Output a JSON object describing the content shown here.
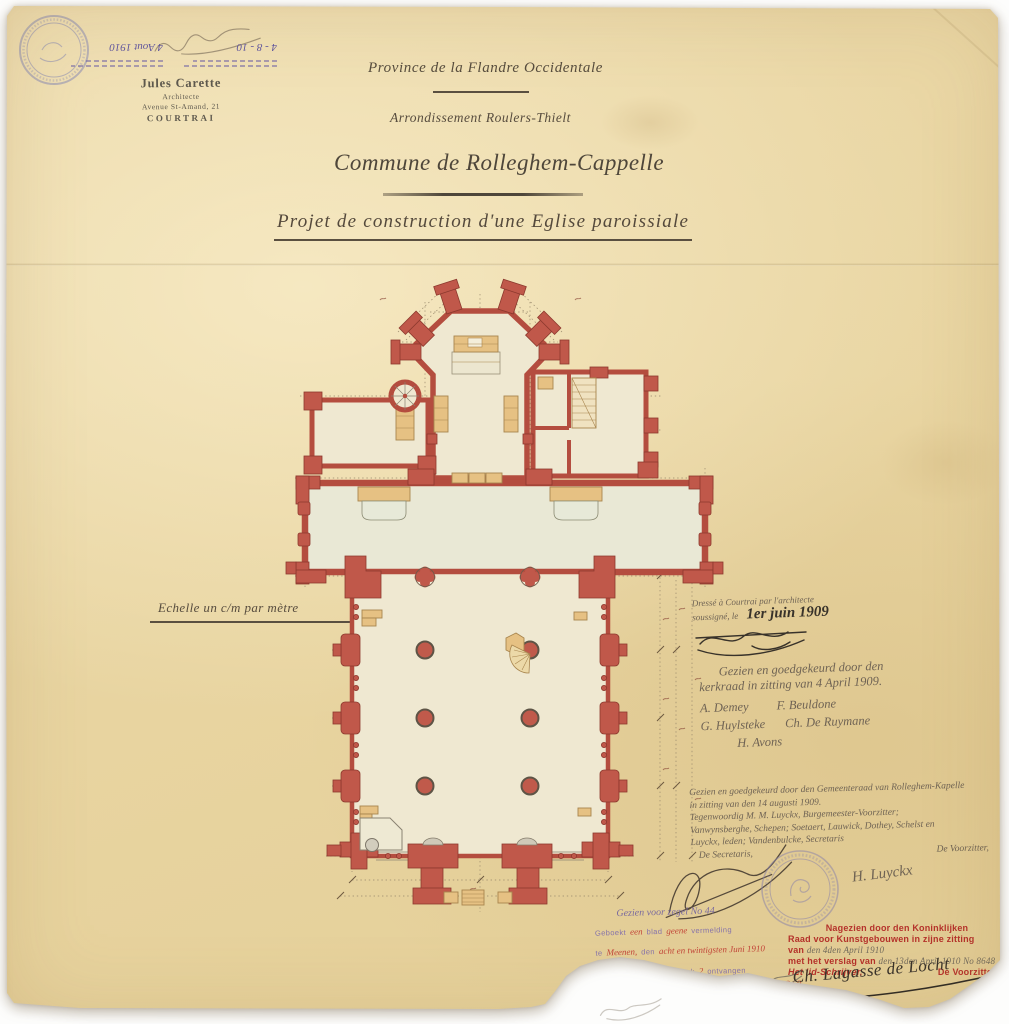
{
  "corner_stamps": {
    "date_handwritten_1": "4 - 8 - 10",
    "date_handwritten_2": "4 Aout 1910"
  },
  "architect_stamp": {
    "name": "Jules Carette",
    "title": "Architecte",
    "address": "Avenue St-Amand, 21",
    "city": "COURTRAI"
  },
  "headings": {
    "province": "Province de la Flandre Occidentale",
    "arrondissement": "Arrondissement Roulers-Thielt",
    "commune": "Commune de Rolleghem-Cappelle",
    "project_title": "Projet de construction d'une Eglise paroissiale",
    "scale_note": "Echelle un c/m par mètre"
  },
  "drafted_note": {
    "line1": "Dressé à Courtrai par l'architecte",
    "line2": "soussigné, le",
    "date": "1er juin 1909"
  },
  "kerkraad_note": {
    "line1": "Gezien en goedgekeurd door den",
    "line2": "kerkraad in zitting van 4 April 1909.",
    "sig1": "A. Demey",
    "sig2": "F. Beuldone",
    "sig3": "G. Huylsteke",
    "sig4": "Ch. De Ruymane",
    "sig5": "H. Avons"
  },
  "gemeenteraad_note": {
    "line1": "Gezien en goedgekeurd door den Gemeenteraad van Rolleghem-Kapelle",
    "line2": "in zitting van den 14 augusti 1909.",
    "line3": "Tegenwoordig M. M. Luyckx, Burgemeester-Voorzitter;",
    "line4": "Vanwynsberghe, Schepen; Soetaert, Lauwick, Dothey, Schelst en",
    "line5": "Luyckx, leden; Vandenbulcke, Secretaris",
    "secretary_title": "De Secretaris,",
    "chairman_title": "De Voorzitter,",
    "chairman_signature": "H. Luyckx"
  },
  "receipt": {
    "line1": "Gezien voor zegel No 44",
    "l2a": "Geboekt",
    "l2b": "een",
    "l2c": "blad",
    "l2d": "geene",
    "l2e": "vermelding",
    "l3a": "te",
    "l3b": "Meenen,",
    "l3c": "den",
    "l3d": "acht en twintigsten Juni 1910",
    "l4a": "deel boek",
    "l4b": "9a",
    "l4c": "blad",
    "l4d": "94",
    "l4e": "vak",
    "l4f": "2",
    "l4g": "ontvangen",
    "l5": "twee frank zestig centiemen voor zegelrecht",
    "amount1": "2.60",
    "l6": "twee frank dertig ct. voor zegel . . .",
    "amount2": "2.30",
    "total": "4.90",
    "receiver_title": "De Ontvanger,"
  },
  "commission_stamp": {
    "line1": "Nagezien door den Koninklijken",
    "line2": "Raad voor Kunstgebouwen in zijne zitting",
    "van_label": "van",
    "van_value": "den 4den April 1910",
    "verslag_label": "met het verslag van",
    "verslag_value": "den 13den April 1910 No 8648",
    "clerk_title": "Het lid-Schrijver,",
    "chairman_title": "De Voorzitter,",
    "chairman_signature": "Ch. Lagasse de Locht"
  },
  "colors": {
    "paper": "#e9d6a6",
    "wall_red": "#c0584a",
    "stamp_red": "#b5322b",
    "stamp_purple": "#7b68ad",
    "pencil": "#6b5f50",
    "ink": "#38322a"
  }
}
